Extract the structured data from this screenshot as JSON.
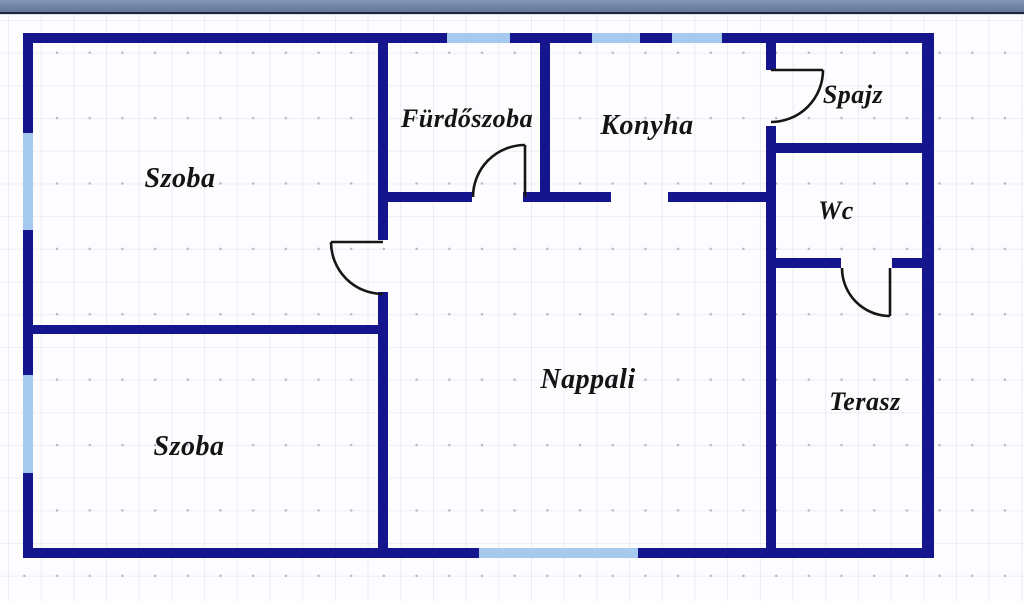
{
  "colors": {
    "wall": "#15158d",
    "window": "#a6caee",
    "door": "#161616",
    "titlebar_top": "#8497b7",
    "titlebar_bottom": "#60769c",
    "titlebar_edge": "#1e2537",
    "canvas_background": "#fdfdff",
    "grid": "#8c96b0",
    "label_text": "#141414"
  },
  "floorplan": {
    "rooms": [
      {
        "id": "szoba-1",
        "label": "Szoba",
        "cx": 180,
        "cy": 179
      },
      {
        "id": "furdoszoba",
        "label": "Fürdőszoba",
        "cx": 467,
        "cy": 119
      },
      {
        "id": "konyha",
        "label": "Konyha",
        "cx": 647,
        "cy": 126
      },
      {
        "id": "spajz",
        "label": "Spajz",
        "cx": 853,
        "cy": 95
      },
      {
        "id": "wc",
        "label": "Wc",
        "cx": 836,
        "cy": 211
      },
      {
        "id": "nappali",
        "label": "Nappali",
        "cx": 588,
        "cy": 380
      },
      {
        "id": "terasz",
        "label": "Terasz",
        "cx": 865,
        "cy": 402
      },
      {
        "id": "szoba-2",
        "label": "Szoba",
        "cx": 189,
        "cy": 447
      }
    ],
    "walls": [
      {
        "x": 23,
        "y": 33,
        "w": 424,
        "h": 10
      },
      {
        "x": 510,
        "y": 33,
        "w": 82,
        "h": 10
      },
      {
        "x": 640,
        "y": 33,
        "w": 32,
        "h": 10
      },
      {
        "x": 722,
        "y": 33,
        "w": 212,
        "h": 10
      },
      {
        "x": 23,
        "y": 33,
        "w": 10,
        "h": 100
      },
      {
        "x": 23,
        "y": 230,
        "w": 10,
        "h": 145
      },
      {
        "x": 23,
        "y": 473,
        "w": 10,
        "h": 85
      },
      {
        "x": 922,
        "y": 33,
        "w": 12,
        "h": 525
      },
      {
        "x": 23,
        "y": 548,
        "w": 456,
        "h": 10
      },
      {
        "x": 638,
        "y": 548,
        "w": 296,
        "h": 10
      },
      {
        "x": 378,
        "y": 43,
        "w": 10,
        "h": 197
      },
      {
        "x": 378,
        "y": 292,
        "w": 10,
        "h": 256
      },
      {
        "x": 33,
        "y": 325,
        "w": 345,
        "h": 9
      },
      {
        "x": 540,
        "y": 43,
        "w": 10,
        "h": 159
      },
      {
        "x": 388,
        "y": 192,
        "w": 84,
        "h": 10
      },
      {
        "x": 523,
        "y": 192,
        "w": 88,
        "h": 10
      },
      {
        "x": 668,
        "y": 192,
        "w": 98,
        "h": 10
      },
      {
        "x": 766,
        "y": 43,
        "w": 10,
        "h": 27
      },
      {
        "x": 766,
        "y": 126,
        "w": 10,
        "h": 422
      },
      {
        "x": 776,
        "y": 143,
        "w": 146,
        "h": 10
      },
      {
        "x": 776,
        "y": 258,
        "w": 65,
        "h": 10
      },
      {
        "x": 892,
        "y": 258,
        "w": 30,
        "h": 10
      }
    ],
    "windows": [
      {
        "x": 447,
        "y": 33,
        "w": 63,
        "h": 10
      },
      {
        "x": 592,
        "y": 33,
        "w": 48,
        "h": 10
      },
      {
        "x": 672,
        "y": 33,
        "w": 50,
        "h": 10
      },
      {
        "x": 23,
        "y": 133,
        "w": 10,
        "h": 97
      },
      {
        "x": 23,
        "y": 375,
        "w": 10,
        "h": 98
      },
      {
        "x": 479,
        "y": 548,
        "w": 159,
        "h": 10
      }
    ],
    "doors": [
      {
        "id": "szoba-door",
        "leaf": "M383,242 L331,242",
        "arc": "M331,242 A52,52 0 0 0 383,294"
      },
      {
        "id": "furdoszoba-door",
        "leaf": "M525,197 L525,145",
        "arc": "M473,197 A52,52 0 0 1 525,145"
      },
      {
        "id": "spajz-door",
        "leaf": "M771,70 L823,70",
        "arc": "M823,70 A52,52 0 0 1 771,122"
      },
      {
        "id": "wc-door",
        "leaf": "M890,268 L890,316",
        "arc": "M842,268 A48,48 0 0 0 890,316"
      }
    ]
  }
}
